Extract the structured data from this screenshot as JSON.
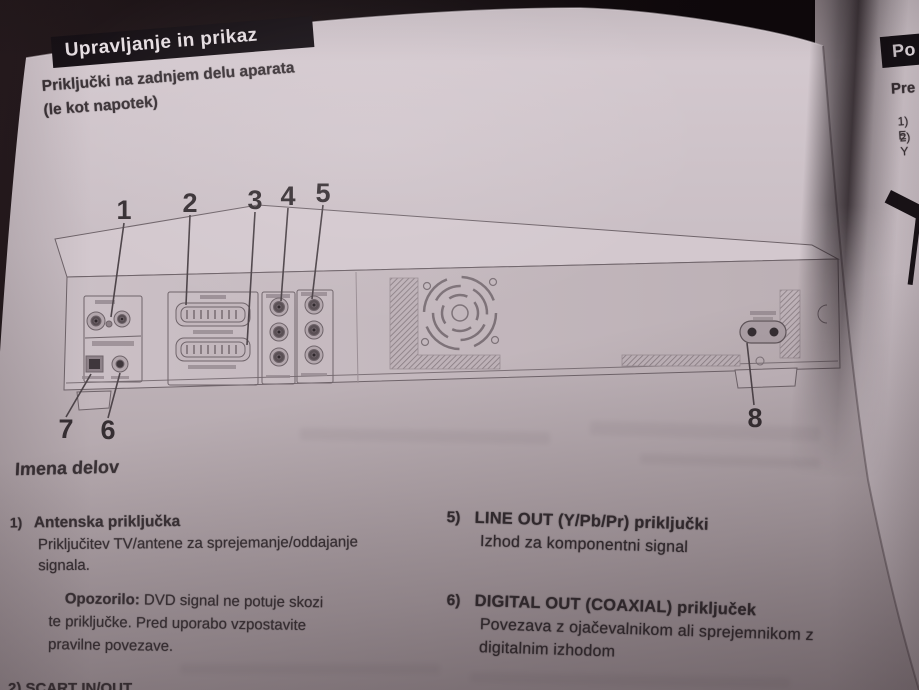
{
  "page": {
    "banner": "Upravljanje in prikaz",
    "subtitle": [
      "Priključki na zadnjem delu aparata",
      "(le kot napotek)"
    ],
    "parts_heading": "Imena delov",
    "diagram": {
      "callouts": [
        "1",
        "2",
        "3",
        "4",
        "5",
        "6",
        "7",
        "8"
      ]
    },
    "items": {
      "item1": {
        "num": "1)",
        "title": "Antenska priključka",
        "body1": "Priključitev TV/antene za sprejemanje/oddajanje",
        "body2": "signala."
      },
      "note": {
        "label": "Opozorilo:",
        "text1": " DVD signal ne potuje skozi",
        "text2": "te priključke. Pred uporabo vzpostavite",
        "text3": "pravilne povezave."
      },
      "item5": {
        "num": "5)",
        "title": "LINE OUT (Y/Pb/Pr) priključki",
        "body1": "Izhod za komponentni signal"
      },
      "item6": {
        "num": "6)",
        "title": "DIGITAL OUT (COAXIAL) priključek",
        "body1": "Povezava z ojačevalnikom ali sprejemnikom z",
        "body2": "digitalnim izhodom"
      }
    },
    "bottom_cut_text": "2) SCART IN/OUT"
  },
  "adjacent_page": {
    "banner_fragment": "Po",
    "heading_fragment": "Pre",
    "list_fragment1": "1) E",
    "list_fragment2": "2) Y"
  },
  "colors": {
    "page": "#c9bec4",
    "ink": "#3a3236",
    "banner_bg": "#171116",
    "banner_text": "#ece4e8",
    "background": "#140d10"
  }
}
